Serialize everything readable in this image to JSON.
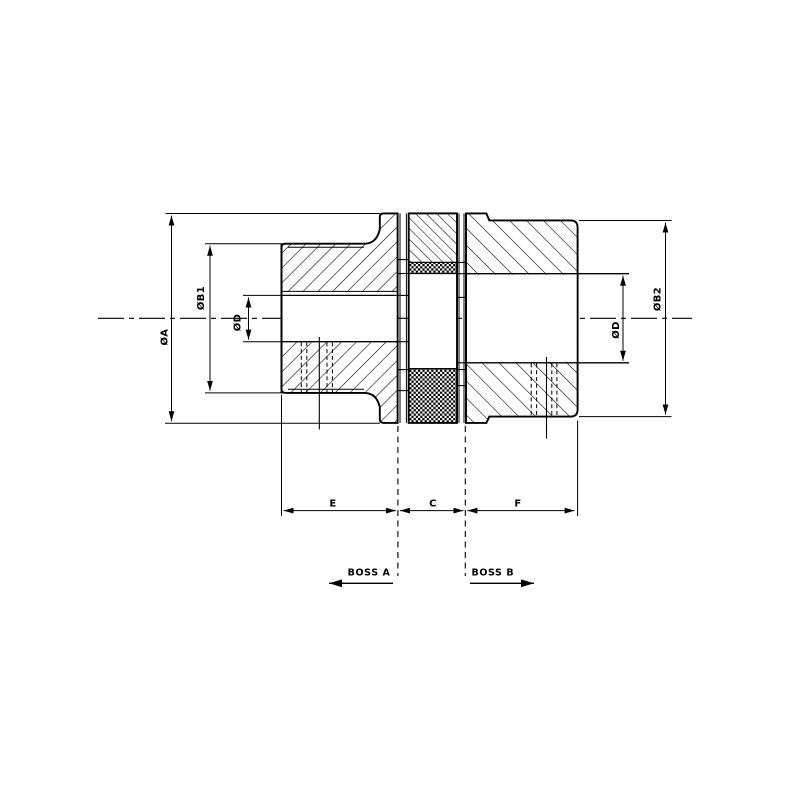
{
  "drawing": {
    "background_color": "#ffffff",
    "line_color": "#000000",
    "labels": {
      "dia_a": "ØA",
      "dia_b1": "ØB1",
      "dia_d_left": "ØD",
      "dia_d_right": "ØD",
      "dia_b2": "ØB2",
      "len_e": "E",
      "len_c": "C",
      "len_f": "F",
      "boss_a": "BOSS A",
      "boss_b": "BOSS B"
    }
  }
}
